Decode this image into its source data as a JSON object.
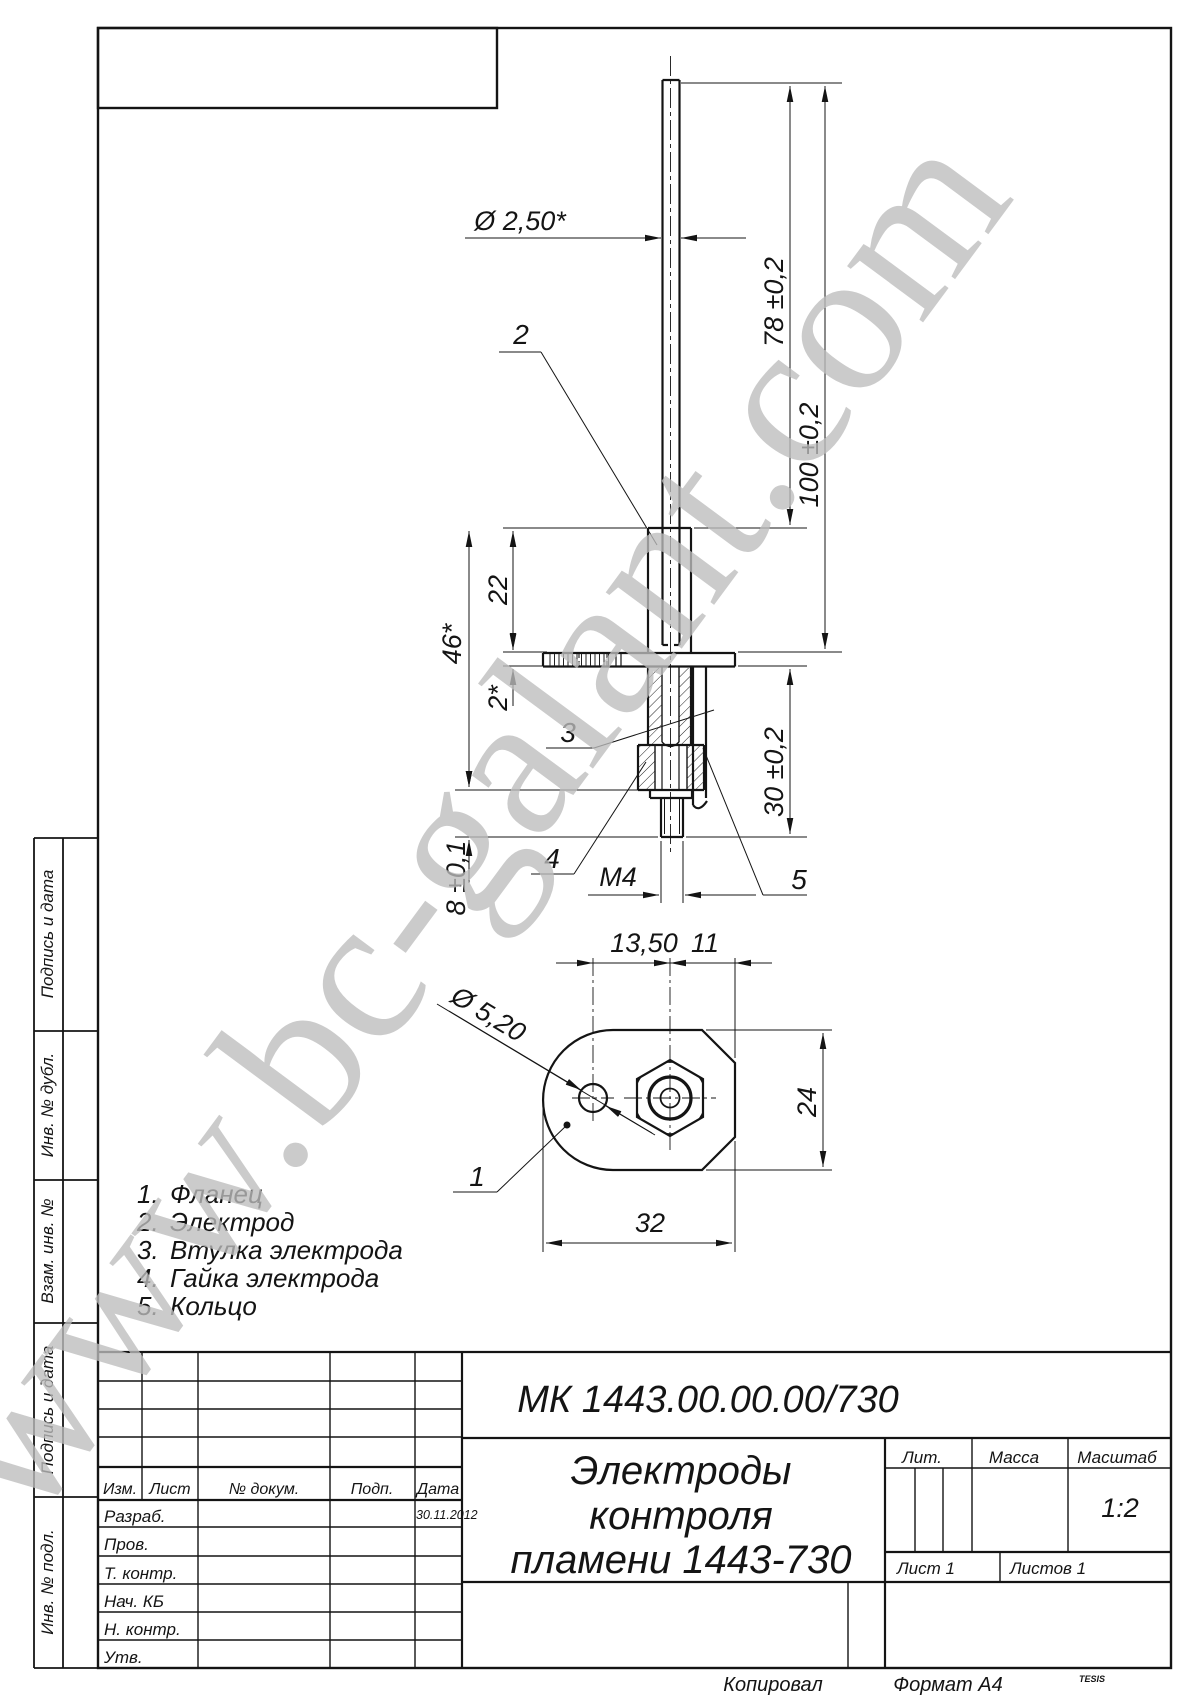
{
  "watermark": {
    "text": "www.bc-galant.com",
    "color": "#bdbdbd"
  },
  "dims": {
    "rod_dia": "Ø 2,50*",
    "l78": "78 ±0,2",
    "l100": "100 ±0,2",
    "l22": "22",
    "l46": "46*",
    "l2": "2*",
    "l30": "30 ±0,2",
    "l8": "8 ±0,1",
    "m4": "M4",
    "l135": "13,50",
    "l11": "11",
    "hole_dia": "Ø 5,20",
    "l24": "24",
    "l32": "32"
  },
  "callouts": {
    "c1": "1",
    "c2": "2",
    "c3": "3",
    "c4": "4",
    "c5": "5"
  },
  "parts_list": {
    "items": [
      {
        "num": "1.",
        "name": "Фланец"
      },
      {
        "num": "2.",
        "name": "Электрод"
      },
      {
        "num": "3.",
        "name": "Втулка электрода"
      },
      {
        "num": "4.",
        "name": "Гайка электрода"
      },
      {
        "num": "5.",
        "name": "Кольцо"
      }
    ]
  },
  "side_labels": {
    "s1": "Подпись и дата",
    "s2": "Инв. № дубл.",
    "s3": "Взам. инв. №",
    "s4": "Подпись и дата",
    "s5": "Инв. № подл."
  },
  "title_block": {
    "designation": "МК 1443.00.00.00/730",
    "title_line1": "Электроды",
    "title_line2": "контроля",
    "title_line3": "пламени 1443-730",
    "lit_label": "Лит.",
    "mass_label": "Масса",
    "scale_label": "Масштаб",
    "scale_value": "1:2",
    "sheet": "Лист 1",
    "sheets": "Листов 1",
    "col_izm": "Изм.",
    "col_list": "Лист",
    "col_doc": "№ докум.",
    "col_sign": "Подп.",
    "col_date": "Дата",
    "date_value": "30.11.2012",
    "row_razrab": "Разраб.",
    "row_prov": "Пров.",
    "row_tkontr": "Т. контр.",
    "row_nachkb": "Нач. КБ",
    "row_nkontr": "Н. контр.",
    "row_utv": "Утв."
  },
  "footer": {
    "copied": "Копировал",
    "format": "Формат А4",
    "brand": "TESIS"
  }
}
